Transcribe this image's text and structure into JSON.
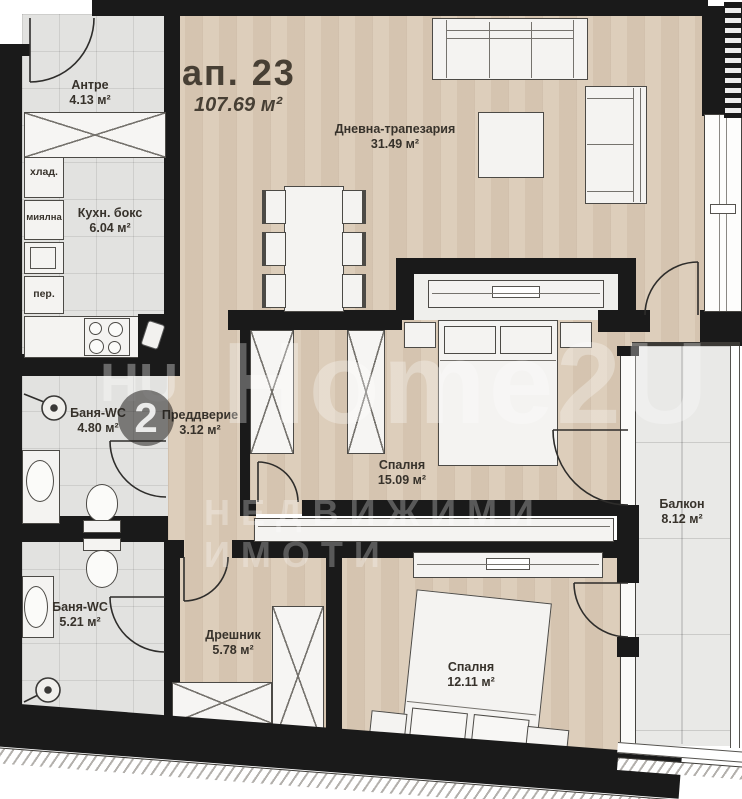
{
  "title": {
    "apartment": "ап. 23",
    "total_area": "107.69 м²"
  },
  "rooms": {
    "antre": {
      "name": "Антре",
      "area": "4.13 м²"
    },
    "kitchen": {
      "name": "Кухн. бокс",
      "area": "6.04 м²"
    },
    "living": {
      "name": "Дневна-трапезария",
      "area": "31.49 м²"
    },
    "bath1": {
      "name": "Баня-WC",
      "area": "4.80 м²"
    },
    "vestibule": {
      "name": "Преддверие",
      "area": "3.12 м²"
    },
    "bedroom1": {
      "name": "Спалня",
      "area": "15.09 м²"
    },
    "balcony": {
      "name": "Балкон",
      "area": "8.12 м²"
    },
    "bath2": {
      "name": "Баня-WC",
      "area": "5.21 м²"
    },
    "closet": {
      "name": "Дрешник",
      "area": "5.78 м²"
    },
    "bedroom2": {
      "name": "Спалня",
      "area": "12.11 м²"
    }
  },
  "appliances": {
    "fridge": "хлад.",
    "dishwasher": "миялна",
    "washer": "пер."
  },
  "watermark": {
    "brand": "Home2U",
    "tagline": "НЕДВИЖИМИ ИМОТИ",
    "logo_letters": "HU",
    "logo_digit": "2"
  },
  "colors": {
    "wall": "#1a1a1a",
    "wood_floor": "#d9c8b3",
    "tile_floor": "#e2e2e0",
    "balcony_tile": "#e9e9e7",
    "furniture": "#f4f3f1",
    "label_text": "#37322b"
  }
}
